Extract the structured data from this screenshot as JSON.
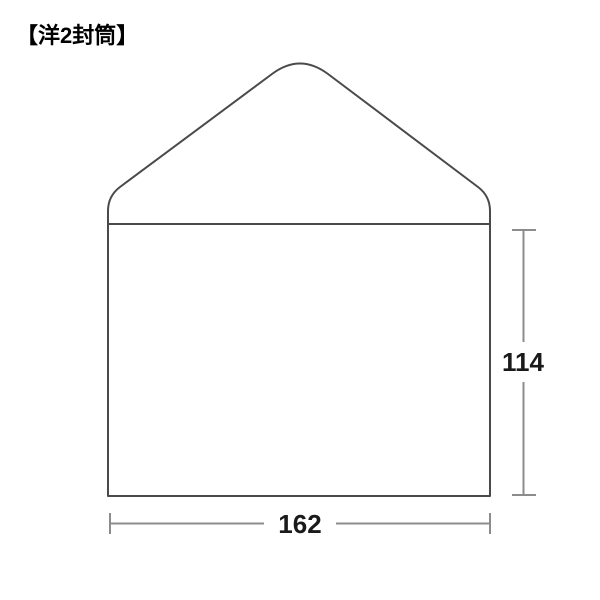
{
  "title": {
    "text": "【洋2封筒】"
  },
  "diagram": {
    "width_label": "162",
    "height_label": "114",
    "colors": {
      "outline": "#4a4a4a",
      "dimension": "#8c8c8c",
      "label_text": "#1a1a1a",
      "background": "#ffffff"
    }
  }
}
